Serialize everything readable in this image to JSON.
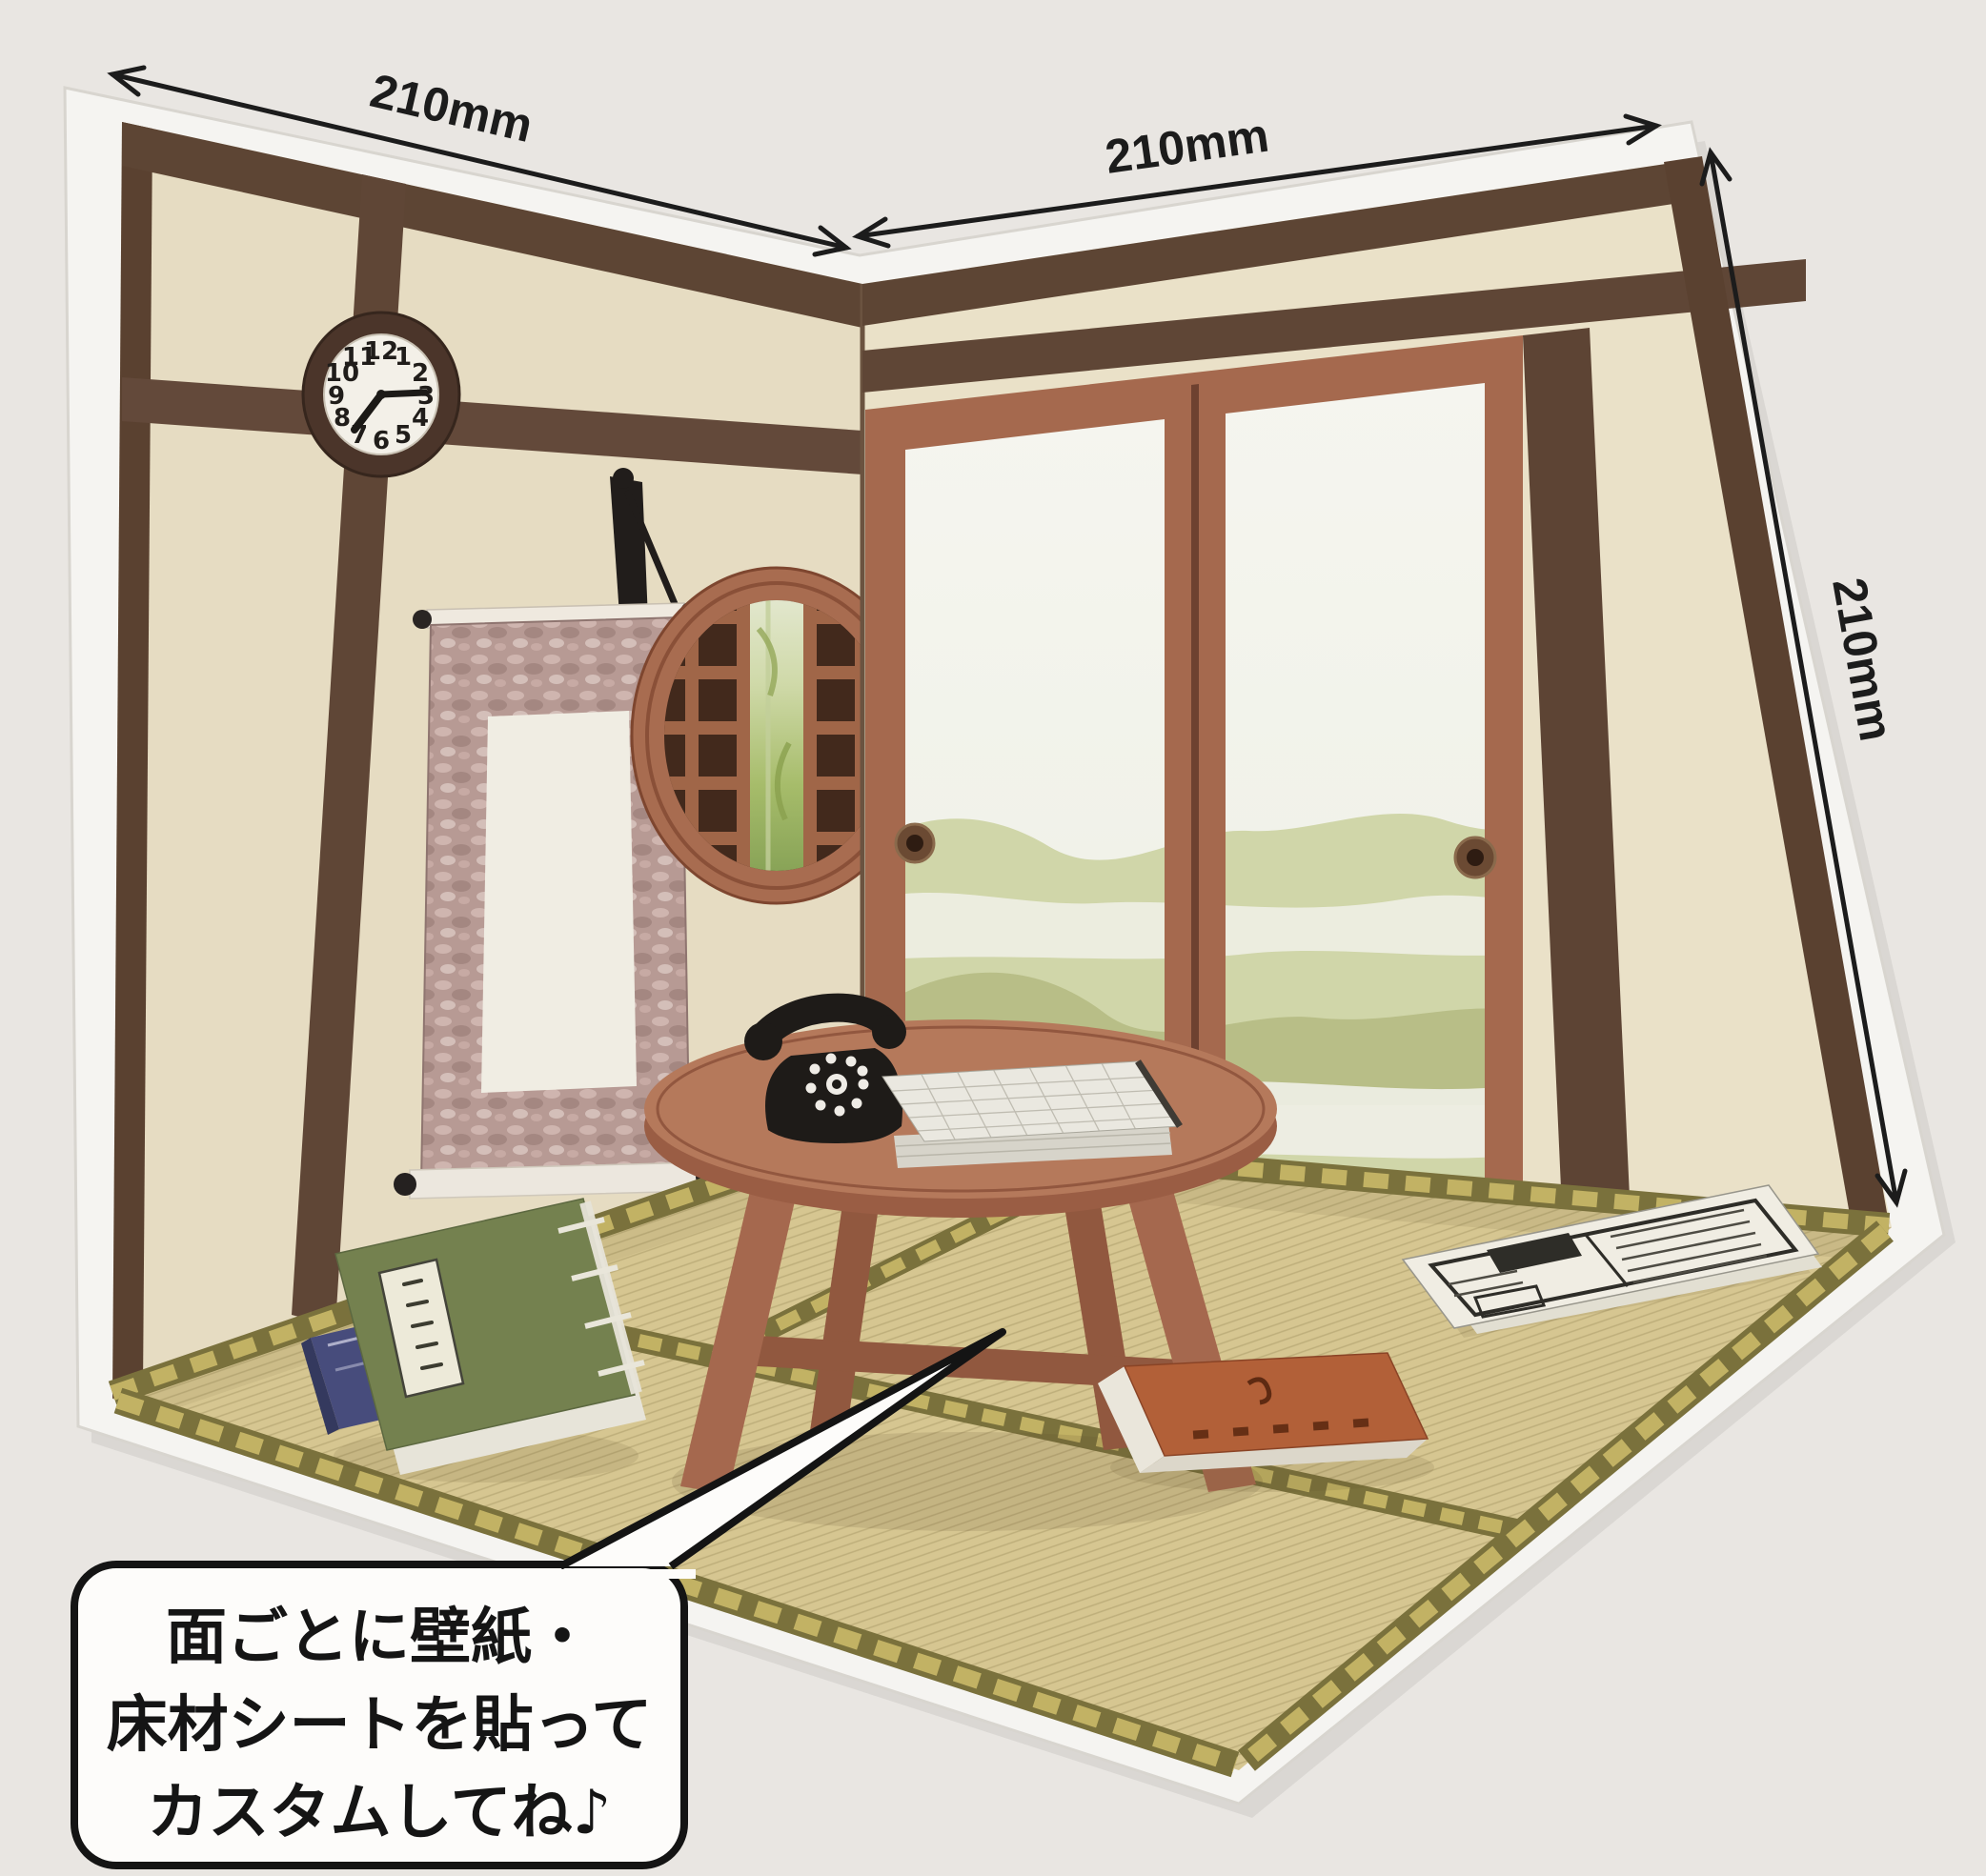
{
  "annotations": {
    "dim_top_left": "210mm",
    "dim_top_right": "210mm",
    "dim_right_side": "210mm"
  },
  "speech_bubble": {
    "line1": "面ごとに壁紙・",
    "line2": "床材シートを貼って",
    "line3": "カスタムしてね♪"
  },
  "clock": {
    "time_shown": "7:15",
    "numbers": [
      "12",
      "1",
      "2",
      "3",
      "4",
      "5",
      "6",
      "7",
      "8",
      "9",
      "10",
      "11"
    ]
  },
  "colors": {
    "background": "#e9e6e2",
    "base_paper": "#f5f4f1",
    "wall_left": "#e6dcc2",
    "wall_right": "#eae1c8",
    "beam_dark": "#5d4534",
    "frame_terracotta": "#a5694e",
    "tatami": "#d6c691",
    "tatami_edge": "#7a713c",
    "table": "#b5795b",
    "scroll_border": "#b79a94",
    "phone_black": "#1e1b18",
    "ink": "#1c1c1c"
  }
}
